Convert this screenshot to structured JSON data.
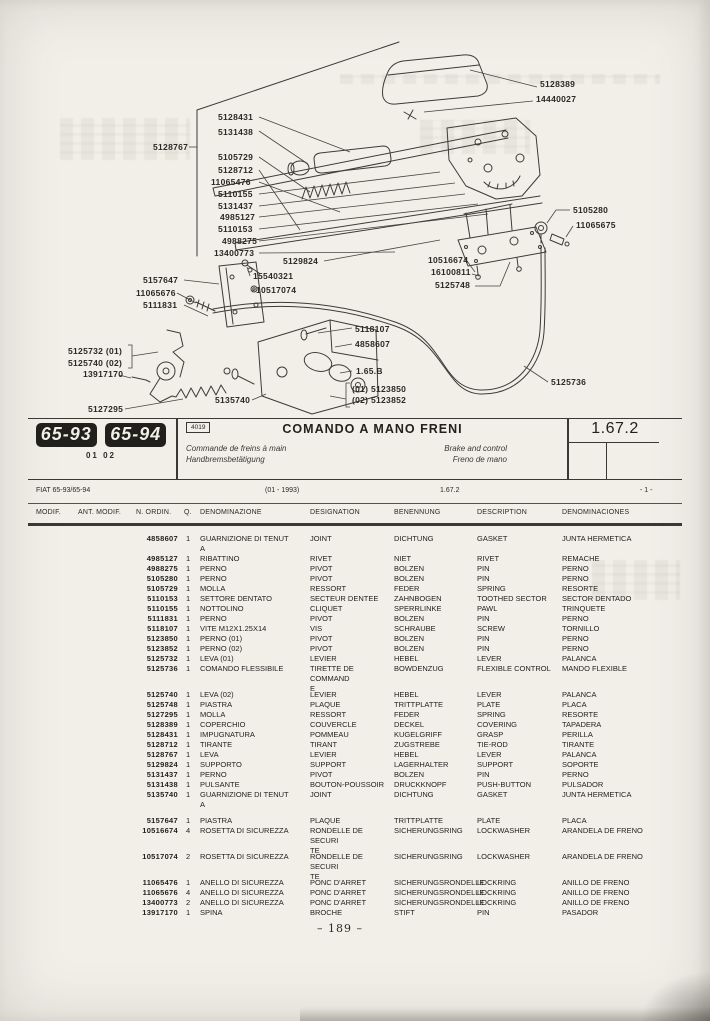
{
  "colors": {
    "paper": "#f1efe8",
    "ink": "#22211e"
  },
  "diagram": {
    "labels": [
      "5128389",
      "14440027",
      "5128431",
      "5131438",
      "5128767",
      "5105729",
      "5128712",
      "11065476",
      "5110155",
      "5131437",
      "4985127",
      "5110153",
      "4988275",
      "13400773",
      "5129824",
      "15540321",
      "10517074",
      "5157647",
      "11065676",
      "5111831",
      "10516674",
      "16100811",
      "5125748",
      "5105280",
      "11065675",
      "5118107",
      "4858607",
      "1.65.B",
      "(01)  5123850",
      "(02)  5123852",
      "5135740",
      "5125736",
      "5125732  (01)",
      "5125740  (02)",
      "13917170",
      "5127295"
    ]
  },
  "header_band": {
    "model_badges": [
      "65-93",
      "65-94"
    ],
    "variant_codes": "01 02",
    "figure_code": "4019",
    "title": "COMANDO A MANO FRENI",
    "subtitle_fr": "Commande de freins à main",
    "subtitle_de": "Handbremsbetätigung",
    "subtitle_en": "Brake and control",
    "subtitle_es": "Freno de mano",
    "section_code": "1.67.2"
  },
  "table_meta": {
    "model": "FIAT 65-93/65-94",
    "date_range": "(01 - 1993)",
    "section": "1.67.2",
    "sheet": "- 1 -"
  },
  "table": {
    "columns": [
      "MODIF.",
      "ANT. MODIF.",
      "N. ORDIN.",
      "Q.",
      "DENOMINAZIONE",
      "DESIGNATION",
      "BENENNUNG",
      "DESCRIPTION",
      "DENOMINACIONES"
    ],
    "rows": [
      {
        "n": "4858607",
        "q": "1",
        "it": "GUARNIZIONE DI TENUT\nA",
        "fr": "JOINT",
        "de": "DICHTUNG",
        "en": "GASKET",
        "es": "JUNTA HERMETICA",
        "gap": false
      },
      {
        "n": "4985127",
        "q": "1",
        "it": "RIBATTINO",
        "fr": "RIVET",
        "de": "NIET",
        "en": "RIVET",
        "es": "REMACHE",
        "gap": false
      },
      {
        "n": "4988275",
        "q": "1",
        "it": "PERNO",
        "fr": "PIVOT",
        "de": "BOLZEN",
        "en": "PIN",
        "es": "PERNO",
        "gap": false
      },
      {
        "n": "5105280",
        "q": "1",
        "it": "PERNO",
        "fr": "PIVOT",
        "de": "BOLZEN",
        "en": "PIN",
        "es": "PERNO",
        "gap": false
      },
      {
        "n": "5105729",
        "q": "1",
        "it": "MOLLA",
        "fr": "RESSORT",
        "de": "FEDER",
        "en": "SPRING",
        "es": "RESORTE",
        "gap": false
      },
      {
        "n": "5110153",
        "q": "1",
        "it": "SETTORE DENTATO",
        "fr": "SECTEUR DENTEE",
        "de": "ZAHNBOGEN",
        "en": "TOOTHED SECTOR",
        "es": "SECTOR DENTADO",
        "gap": false
      },
      {
        "n": "5110155",
        "q": "1",
        "it": "NOTTOLINO",
        "fr": "CLIQUET",
        "de": "SPERRLINKE",
        "en": "PAWL",
        "es": "TRINQUETE",
        "gap": false
      },
      {
        "n": "5111831",
        "q": "1",
        "it": "PERNO",
        "fr": "PIVOT",
        "de": "BOLZEN",
        "en": "PIN",
        "es": "PERNO",
        "gap": false
      },
      {
        "n": "5118107",
        "q": "1",
        "it": "VITE M12X1.25X14",
        "fr": "VIS",
        "de": "SCHRAUBE",
        "en": "SCREW",
        "es": "TORNILLO",
        "gap": false
      },
      {
        "n": "5123850",
        "q": "1",
        "it": "PERNO (01)",
        "fr": "PIVOT",
        "de": "BOLZEN",
        "en": "PIN",
        "es": "PERNO",
        "gap": false
      },
      {
        "n": "5123852",
        "q": "1",
        "it": "PERNO (02)",
        "fr": "PIVOT",
        "de": "BOLZEN",
        "en": "PIN",
        "es": "PERNO",
        "gap": false
      },
      {
        "n": "5125732",
        "q": "1",
        "it": "LEVA (01)",
        "fr": "LEVIER",
        "de": "HEBEL",
        "en": "LEVER",
        "es": "PALANCA",
        "gap": false
      },
      {
        "n": "5125736",
        "q": "1",
        "it": "COMANDO FLESSIBILE",
        "fr": "TIRETTE DE COMMAND\nE",
        "de": "BOWDENZUG",
        "en": "FLEXIBLE CONTROL",
        "es": "MANDO FLEXIBLE",
        "gap": true
      },
      {
        "n": "5125740",
        "q": "1",
        "it": "LEVA (02)",
        "fr": "LEVIER",
        "de": "HEBEL",
        "en": "LEVER",
        "es": "PALANCA",
        "gap": false
      },
      {
        "n": "5125748",
        "q": "1",
        "it": "PIASTRA",
        "fr": "PLAQUE",
        "de": "TRITTPLATTE",
        "en": "PLATE",
        "es": "PLACA",
        "gap": false
      },
      {
        "n": "5127295",
        "q": "1",
        "it": "MOLLA",
        "fr": "RESSORT",
        "de": "FEDER",
        "en": "SPRING",
        "es": "RESORTE",
        "gap": false
      },
      {
        "n": "5128389",
        "q": "1",
        "it": "COPERCHIO",
        "fr": "COUVERCLE",
        "de": "DECKEL",
        "en": "COVERING",
        "es": "TAPADERA",
        "gap": false
      },
      {
        "n": "5128431",
        "q": "1",
        "it": "IMPUGNATURA",
        "fr": "POMMEAU",
        "de": "KUGELGRIFF",
        "en": "GRASP",
        "es": "PERILLA",
        "gap": false
      },
      {
        "n": "5128712",
        "q": "1",
        "it": "TIRANTE",
        "fr": "TIRANT",
        "de": "ZUGSTREBE",
        "en": "TIE-ROD",
        "es": "TIRANTE",
        "gap": false
      },
      {
        "n": "5128767",
        "q": "1",
        "it": "LEVA",
        "fr": "LEVIER",
        "de": "HEBEL",
        "en": "LEVER",
        "es": "PALANCA",
        "gap": false
      },
      {
        "n": "5129824",
        "q": "1",
        "it": "SUPPORTO",
        "fr": "SUPPORT",
        "de": "LAGERHALTER",
        "en": "SUPPORT",
        "es": "SOPORTE",
        "gap": false
      },
      {
        "n": "5131437",
        "q": "1",
        "it": "PERNO",
        "fr": "PIVOT",
        "de": "BOLZEN",
        "en": "PIN",
        "es": "PERNO",
        "gap": false
      },
      {
        "n": "5131438",
        "q": "1",
        "it": "PULSANTE",
        "fr": "BOUTON-POUSSOIR",
        "de": "DRUCKKNOPF",
        "en": "PUSH-BUTTON",
        "es": "PULSADOR",
        "gap": false
      },
      {
        "n": "5135740",
        "q": "1",
        "it": "GUARNIZIONE DI TENUT\nA",
        "fr": "JOINT",
        "de": "DICHTUNG",
        "en": "GASKET",
        "es": "JUNTA HERMETICA",
        "gap": true
      },
      {
        "n": "5157647",
        "q": "1",
        "it": "PIASTRA",
        "fr": "PLAQUE",
        "de": "TRITTPLATTE",
        "en": "PLATE",
        "es": "PLACA",
        "gap": false
      },
      {
        "n": "10516674",
        "q": "4",
        "it": "ROSETTA DI SICUREZZA",
        "fr": "RONDELLE DE SECURI\nTE",
        "de": "SICHERUNGSRING",
        "en": "LOCKWASHER",
        "es": "ARANDELA DE FRENO",
        "gap": true
      },
      {
        "n": "10517074",
        "q": "2",
        "it": "ROSETTA DI SICUREZZA",
        "fr": "RONDELLE DE SECURI\nTE",
        "de": "SICHERUNGSRING",
        "en": "LOCKWASHER",
        "es": "ARANDELA DE FRENO",
        "gap": true
      },
      {
        "n": "11065476",
        "q": "1",
        "it": "ANELLO DI SICUREZZA",
        "fr": "PONC D'ARRET",
        "de": "SICHERUNGSRONDELLE",
        "en": "LOCKRING",
        "es": "ANILLO DE FRENO",
        "gap": false
      },
      {
        "n": "11065676",
        "q": "4",
        "it": "ANELLO DI SICUREZZA",
        "fr": "PONC D'ARRET",
        "de": "SICHERUNGSRONDELLE",
        "en": "LOCKRING",
        "es": "ANILLO DE FRENO",
        "gap": false
      },
      {
        "n": "13400773",
        "q": "2",
        "it": "ANELLO DI SICUREZZA",
        "fr": "PONC D'ARRET",
        "de": "SICHERUNGSRONDELLE",
        "en": "LOCKRING",
        "es": "ANILLO DE FRENO",
        "gap": false
      },
      {
        "n": "13917170",
        "q": "1",
        "it": "SPINA",
        "fr": "BROCHE",
        "de": "STIFT",
        "en": "PIN",
        "es": "PASADOR",
        "gap": false
      }
    ]
  },
  "footer": {
    "page_number": "– 189 –"
  }
}
